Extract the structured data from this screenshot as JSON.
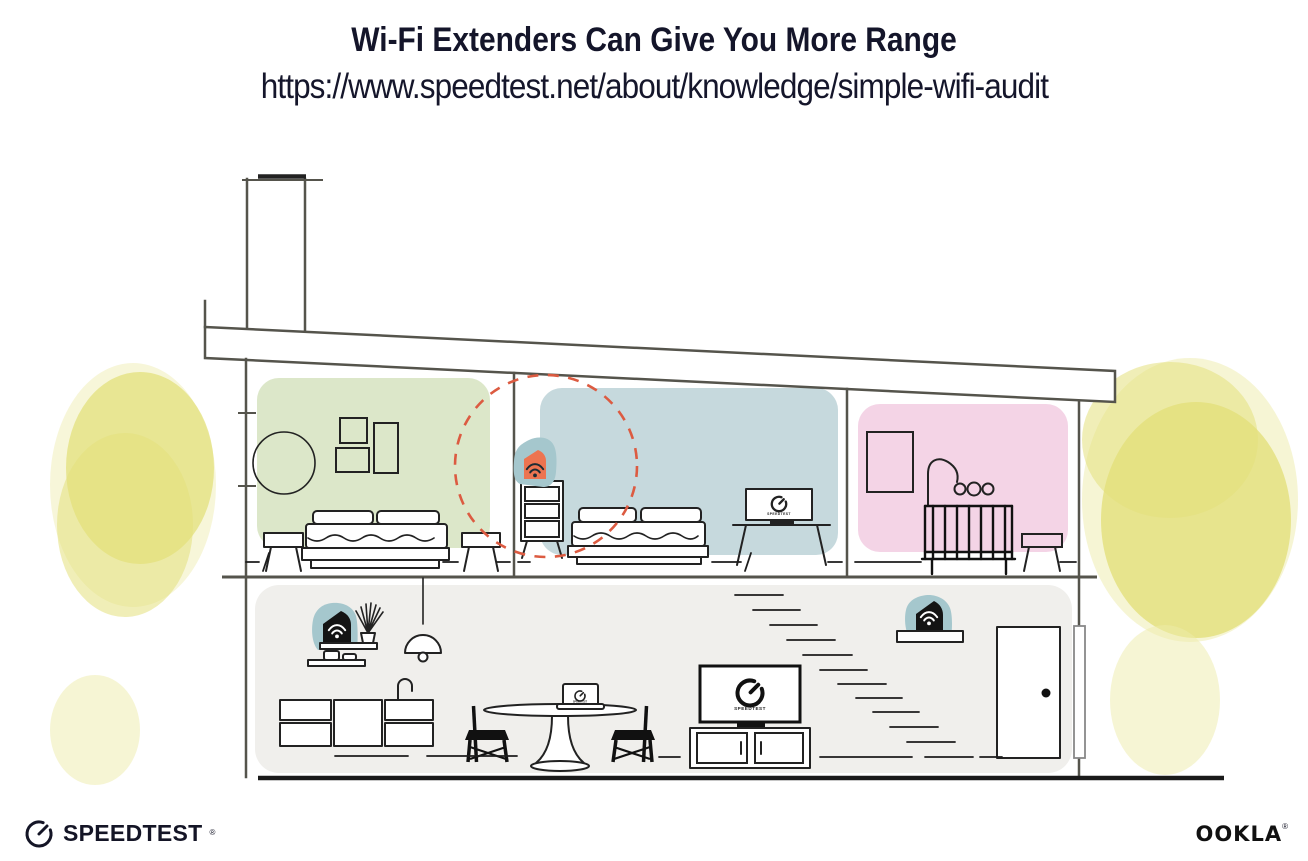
{
  "header": {
    "title": "Wi-Fi Extenders Can Give You More Range",
    "url": "https://www.speedtest.net/about/knowledge/simple-wifi-audit"
  },
  "devices": {
    "tv_bedroom_label": "SPEEDTEST",
    "tv_living_label": "SPEEDTEST",
    "laptop_label": "SPEEDTEST"
  },
  "footer": {
    "speedtest_wordmark": "SPEEDTEST",
    "speedtest_reg_mark": "®",
    "ookla_wordmark": "OOKLA",
    "ookla_reg_mark": "®"
  },
  "icons": {
    "wifi": "wifi-icon",
    "gauge": "speedometer-icon"
  },
  "colors": {
    "heading_text": "#14152a",
    "structure_line": "#55544c",
    "furniture_line": "#222222",
    "bedroom_green": "#dce7c9",
    "bedroom_blue": "#c6d9dd",
    "nursery_pink": "#f4d4e6",
    "ground_floor_gray": "#f0efec",
    "device_teal": "#a5c7cd",
    "extender_orange": "#ed7450",
    "device_black": "#141414",
    "range_circle_red": "#dc5b41",
    "foliage_yellow": "#e3e07b",
    "foliage_yellow_light": "#edebaa"
  }
}
